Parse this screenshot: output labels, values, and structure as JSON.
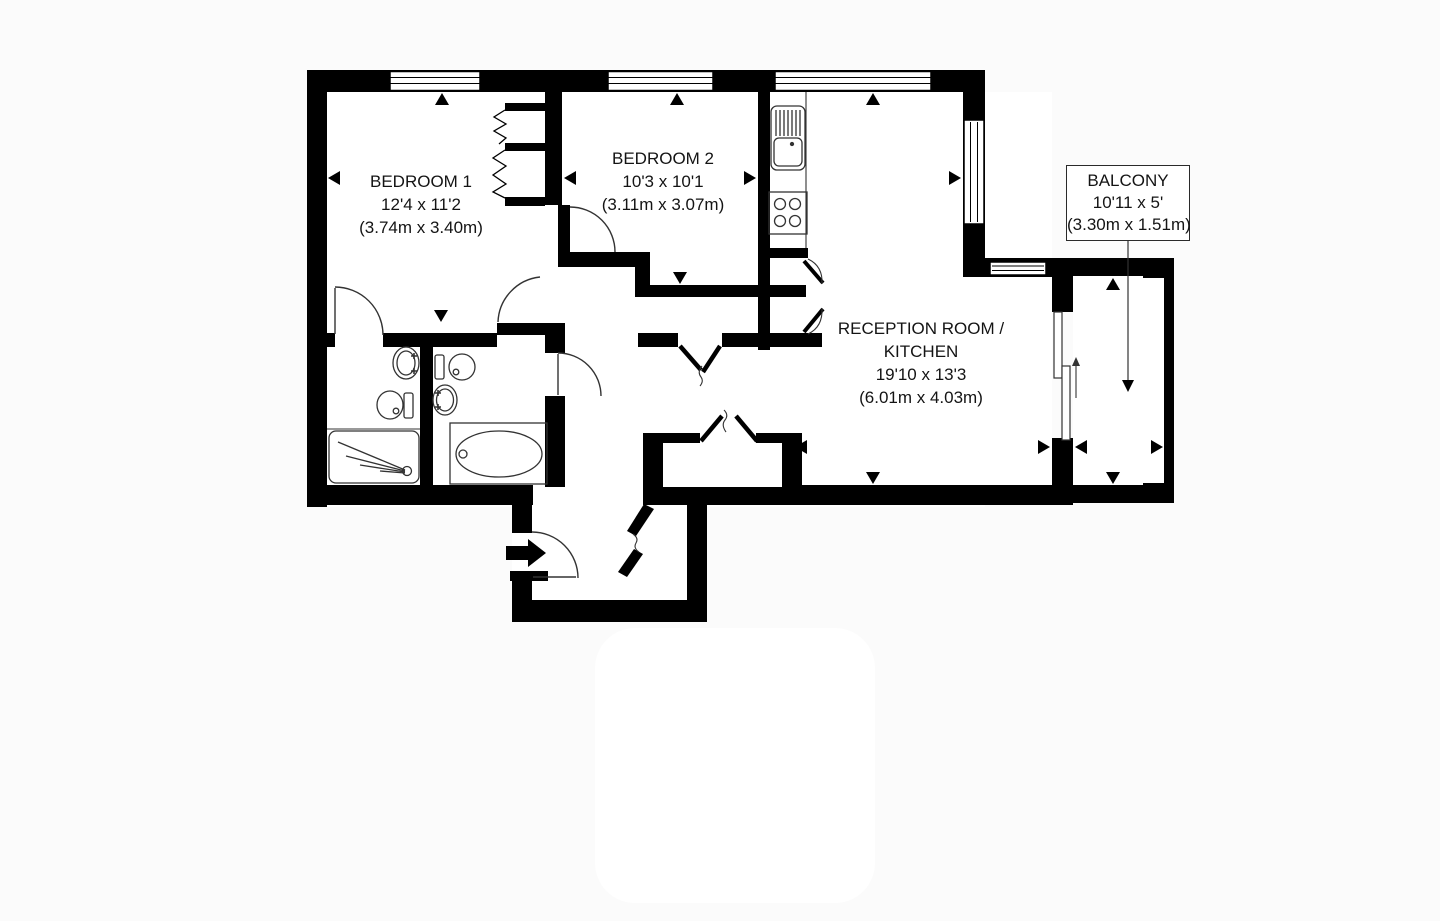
{
  "floorplan": {
    "bedroom1": {
      "name": "BEDROOM 1",
      "size_imperial": "12'4 x 11'2",
      "size_metric": "(3.74m x 3.40m)"
    },
    "bedroom2": {
      "name": "BEDROOM 2",
      "size_imperial": "10'3 x 10'1",
      "size_metric": "(3.11m x 3.07m)"
    },
    "reception": {
      "name_line1": "RECEPTION ROOM /",
      "name_line2": "KITCHEN",
      "size_imperial": "19'10 x 13'3",
      "size_metric": "(6.01m x 4.03m)"
    },
    "balcony": {
      "name": "BALCONY",
      "size_imperial": "10'11 x 5'",
      "size_metric": "(3.30m x 1.51m)"
    },
    "colors": {
      "wall": "#000000",
      "background": "#ffffff",
      "text": "#141414"
    }
  }
}
